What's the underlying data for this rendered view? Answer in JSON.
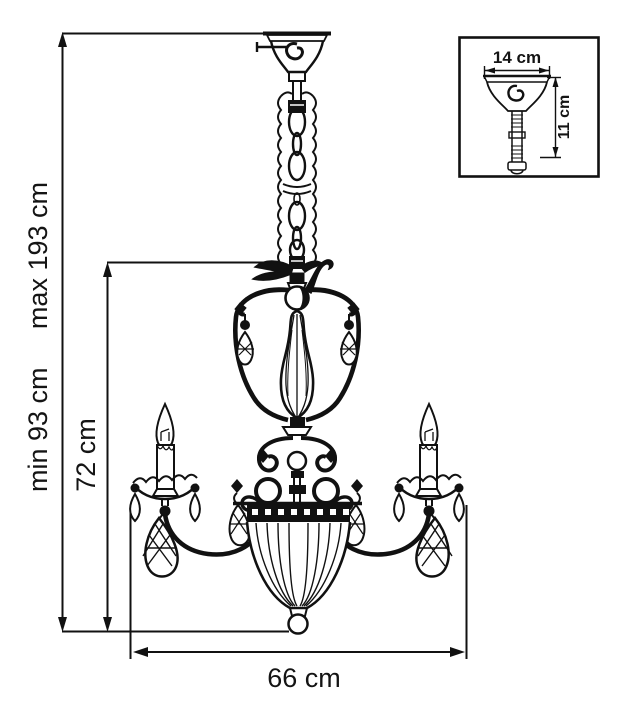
{
  "annotations": {
    "overall_height_min": "min 93 cm",
    "overall_height_max": "max 193 cm",
    "body_height": "72 cm",
    "width": "66 cm"
  },
  "inset": {
    "canopy_width": "14 cm",
    "canopy_height": "11 cm"
  },
  "colors": {
    "line": "#000000",
    "background": "#ffffff"
  }
}
